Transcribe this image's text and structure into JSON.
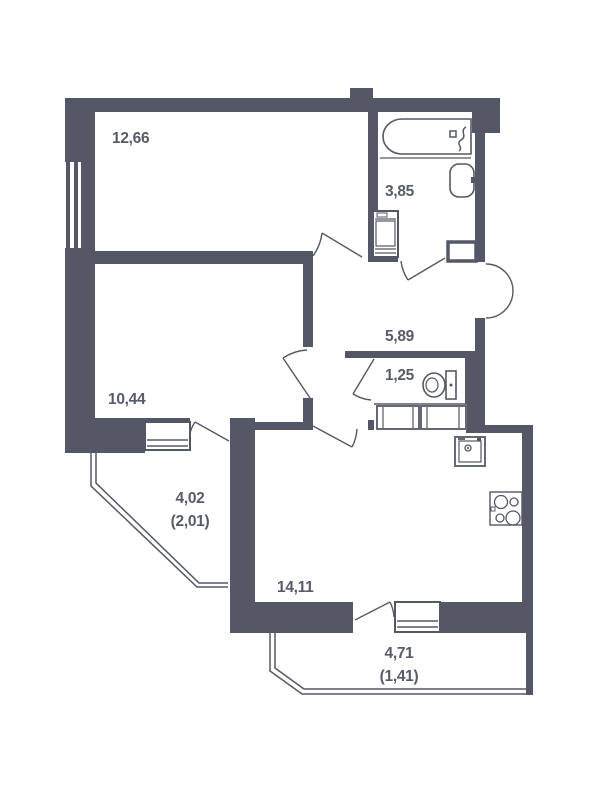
{
  "plan_title": "apartment floor plan",
  "colors": {
    "wall": "#545866",
    "line": "#545866",
    "text": "#565b69",
    "background": "#ffffff",
    "fixture_fill": "#ffffff"
  },
  "rooms": [
    {
      "id": "living-room",
      "area": "12,66"
    },
    {
      "id": "bathroom",
      "area": "3,85"
    },
    {
      "id": "hallway",
      "area": "5,89"
    },
    {
      "id": "wc",
      "area": "1,25"
    },
    {
      "id": "bedroom",
      "area": "10,44"
    },
    {
      "id": "loggia-left",
      "area": "4,02",
      "area_reduced": "(2,01)"
    },
    {
      "id": "kitchen-living",
      "area": "14,11"
    },
    {
      "id": "loggia-bottom",
      "area": "4,71",
      "area_reduced": "(1,41)"
    }
  ],
  "fixtures": [
    "bathtub",
    "bath-faucet",
    "wall-sink",
    "washing-machine",
    "vent-shaft",
    "toilet",
    "wardrobe",
    "kitchen-sink",
    "stove",
    "window",
    "balcony-door",
    "entrance-door"
  ]
}
